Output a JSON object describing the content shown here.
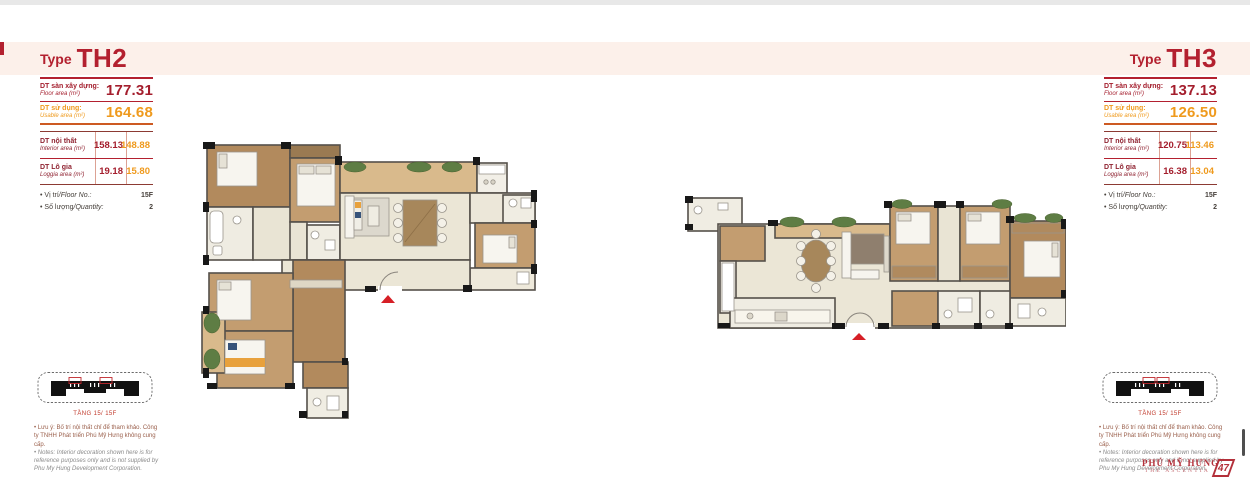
{
  "colors": {
    "accent_red": "#b3202f",
    "accent_orange": "#ef9a1d",
    "band_pink": "#fcf0ea",
    "value_red": "#a41e2d"
  },
  "header": {
    "th2": {
      "prefix": "Type",
      "name": "TH2"
    },
    "th3": {
      "prefix": "Type",
      "name": "TH3"
    }
  },
  "specs": {
    "th2": {
      "floor": {
        "vi": "DT sàn xây dựng:",
        "en": "Floor area (m²)",
        "value": "177.31"
      },
      "usable": {
        "vi": "DT sử dụng:",
        "en": "Usable area (m²)",
        "value": "164.68"
      },
      "interior": {
        "vi": "DT nội thất",
        "en": "Interior area (m²)",
        "v1": "158.13",
        "v2": "148.88"
      },
      "loggia": {
        "vi": "DT Lô gia",
        "en": "Loggia area (m²)",
        "v1": "19.18",
        "v2": "15.80"
      },
      "floor_no": {
        "vi": "• Vị trí",
        "en": "/Floor No.:",
        "value": "15F"
      },
      "quantity": {
        "vi": "• Số lượng",
        "en": "/Quantity:",
        "value": "2"
      }
    },
    "th3": {
      "floor": {
        "vi": "DT sàn xây dựng:",
        "en": "Floor area (m²)",
        "value": "137.13"
      },
      "usable": {
        "vi": "DT sử dụng:",
        "en": "Usable area (m²)",
        "value": "126.50"
      },
      "interior": {
        "vi": "DT nội thất",
        "en": "Interior area (m²)",
        "v1": "120.75",
        "v2": "113.46"
      },
      "loggia": {
        "vi": "DT Lô gia",
        "en": "Loggia area (m²)",
        "v1": "16.38",
        "v2": "13.04"
      },
      "floor_no": {
        "vi": "• Vị trí",
        "en": "/Floor No.:",
        "value": "15F"
      },
      "quantity": {
        "vi": "• Số lượng",
        "en": "/Quantity:",
        "value": "2"
      }
    }
  },
  "keyplan": {
    "caption": "TẦNG 15/ 15F"
  },
  "notes": {
    "vi": "• Lưu ý: Bố trí nội thất chỉ để tham khảo. Công ty TNHH Phát triển Phú Mỹ Hưng không cung cấp.",
    "en": "• Notes: Interior decoration shown here is for reference purposes only and is not supplied by Phu My Hung Development Corporation."
  },
  "footer": {
    "brand": "PHÚ MỸ HƯNG",
    "project": "THE ASCENTIA",
    "page": "47"
  }
}
